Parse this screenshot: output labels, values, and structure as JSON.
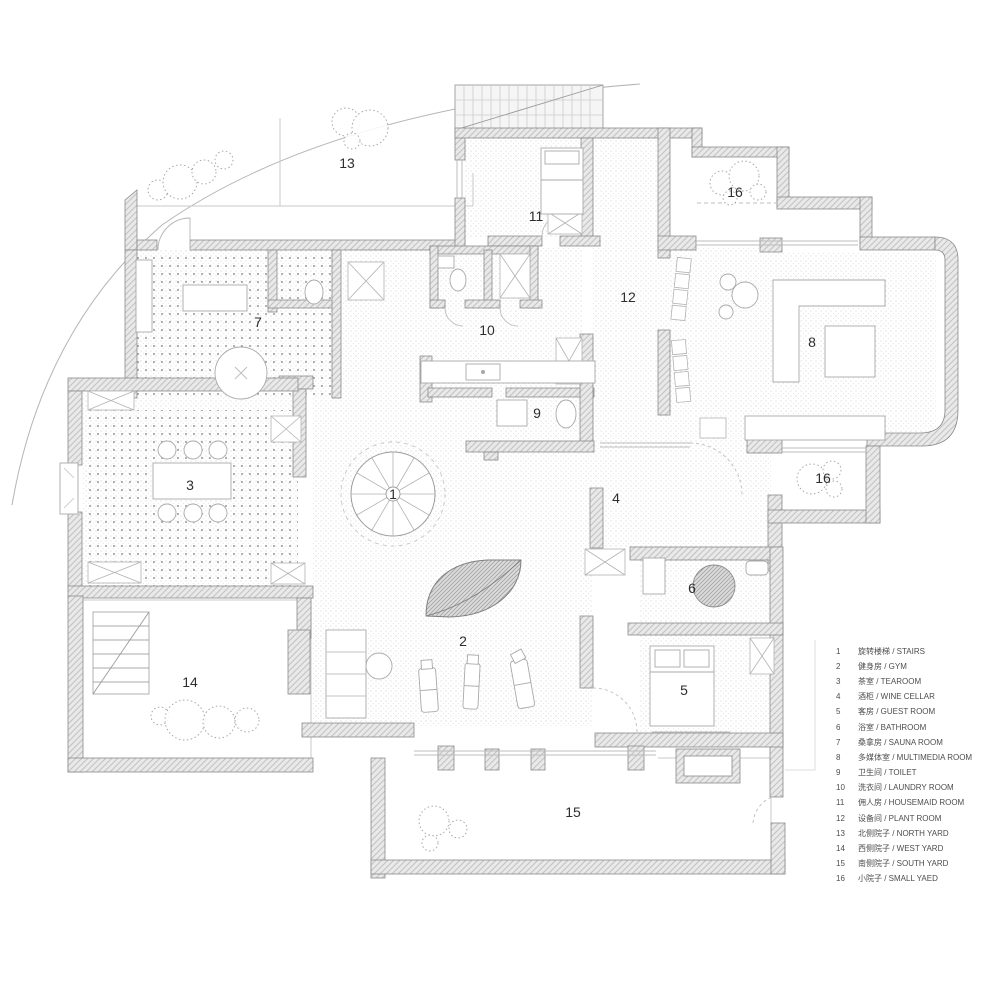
{
  "title": "residential floor plan",
  "colors": {
    "wall_edge": "#8a8a8a",
    "wall_hatch": "#c2c2c2",
    "wall_fill": "#e8e8e8",
    "floor_dot": "#b9b9b9",
    "polka_dot": "#999999",
    "thin_line": "#a9a9a9",
    "window_line": "#bcbcbc",
    "label_text": "#2e2e2e",
    "legend_text": "#4d4d4d"
  },
  "plan": {
    "room_labels": [
      {
        "num": "13"
      },
      {
        "num": "16"
      },
      {
        "num": "11"
      },
      {
        "num": "12"
      },
      {
        "num": "10"
      },
      {
        "num": "7"
      },
      {
        "num": "8"
      },
      {
        "num": "9"
      },
      {
        "num": "3"
      },
      {
        "num": "1"
      },
      {
        "num": "4"
      },
      {
        "num": "16"
      },
      {
        "num": "6"
      },
      {
        "num": "2"
      },
      {
        "num": "5"
      },
      {
        "num": "14"
      },
      {
        "num": "15"
      }
    ]
  },
  "legend": {
    "items": [
      {
        "num": "1",
        "label": "旋转楼梯 / STAIRS"
      },
      {
        "num": "2",
        "label": "健身房 / GYM"
      },
      {
        "num": "3",
        "label": "茶室 / TEAROOM"
      },
      {
        "num": "4",
        "label": "酒柜 / WINE CELLAR"
      },
      {
        "num": "5",
        "label": "客房 / GUEST ROOM"
      },
      {
        "num": "6",
        "label": "浴室 / BATHROOM"
      },
      {
        "num": "7",
        "label": "桑拿房 / SAUNA ROOM"
      },
      {
        "num": "8",
        "label": "多媒体室 / MULTIMEDIA ROOM"
      },
      {
        "num": "9",
        "label": "卫生间 / TOILET"
      },
      {
        "num": "10",
        "label": "洗衣间 / LAUNDRY ROOM"
      },
      {
        "num": "11",
        "label": "佣人房 / HOUSEMAID ROOM"
      },
      {
        "num": "12",
        "label": "设备间 / PLANT ROOM"
      },
      {
        "num": "13",
        "label": "北侧院子 / NORTH YARD"
      },
      {
        "num": "14",
        "label": "西侧院子 / WEST YARD"
      },
      {
        "num": "15",
        "label": "南侧院子 / SOUTH YARD"
      },
      {
        "num": "16",
        "label": "小院子 / SMALL YAED"
      }
    ]
  }
}
